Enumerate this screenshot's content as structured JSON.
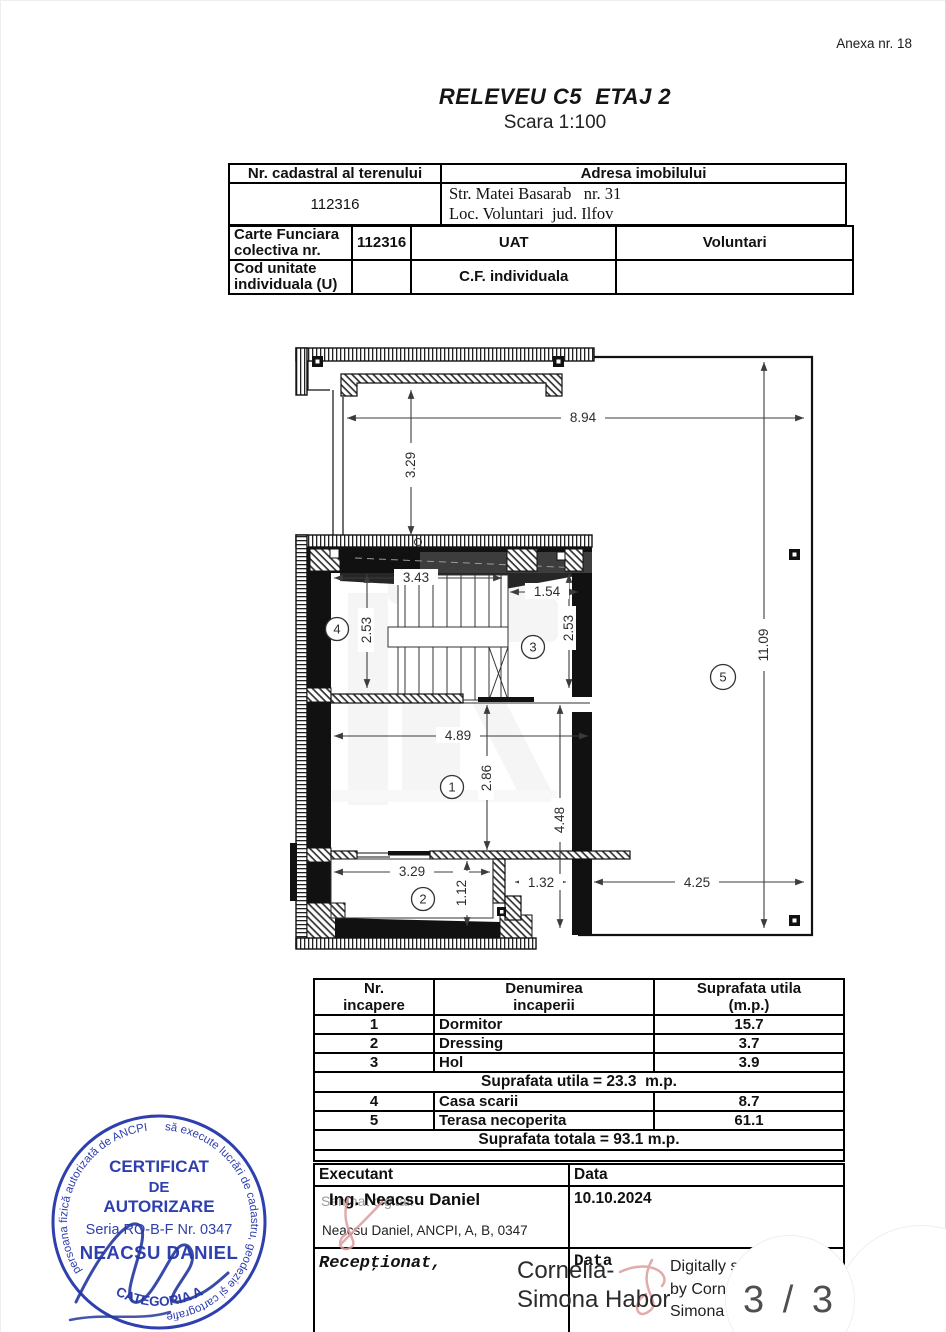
{
  "page": {
    "annex": "Anexa nr. 18",
    "title": "RELEVEU C5  ETAJ 2",
    "subtitle": "Scara 1:100",
    "page_indicator": "3 / 3"
  },
  "property_table": {
    "header_cadastral": "Nr. cadastral al terenului",
    "header_address": "Adresa imobilului",
    "cadastral_number": "112316",
    "address_line1": "Str. Matei Basarab   nr. 31",
    "address_line2": "Loc. Voluntari  jud. Ilfov"
  },
  "cf_table": {
    "row1_label": "Carte Funciara colectiva nr.",
    "row1_value": "112316",
    "row1_uat_label": "UAT",
    "row1_uat_value": "Voluntari",
    "row2_label": "Cod unitate individuala (U)",
    "row2_cf_label": "C.F. individuala"
  },
  "plan": {
    "rooms": {
      "r1": "1",
      "r2": "2",
      "r3": "3",
      "r4": "4",
      "r5": "5"
    },
    "dims": {
      "top_width": "8.94",
      "upper_left_height": "3.29",
      "stair_width": "3.43",
      "hol_width": "1.54",
      "stair_depth": "2.53",
      "hol_depth": "2.53",
      "room1_width": "4.89",
      "room1_depth": "2.86",
      "right_depth": "4.48",
      "room2_width": "3.29",
      "room2_depth": "1.12",
      "hall_width": "1.32",
      "terrace_bottom": "4.25",
      "terrace_height": "11.09"
    }
  },
  "areas_table": {
    "header": {
      "col1_line1": "Nr.",
      "col1_line2": "incapere",
      "col2_line1": "Denumirea",
      "col2_line2": "incaperii",
      "col3_line1": "Suprafata utila",
      "col3_line2": "(m.p.)"
    },
    "rows": [
      {
        "nr": "1",
        "name": "Dormitor",
        "area": "15.7"
      },
      {
        "nr": "2",
        "name": "Dressing",
        "area": "3.7"
      },
      {
        "nr": "3",
        "name": "Hol",
        "area": "3.9"
      }
    ],
    "subtotal": "Suprafata utila = 23.3  m.p.",
    "rows2": [
      {
        "nr": "4",
        "name": "Casa scarii",
        "area": "8.7"
      },
      {
        "nr": "5",
        "name": "Terasa necoperita",
        "area": "61.1"
      }
    ],
    "total": "Suprafata totala = 93.1 m.p."
  },
  "signature_block": {
    "executant_label": "Executant",
    "date_label": "Data",
    "digital_note": "Semnat digital:",
    "executant_name": "Ing. Neacsu Daniel",
    "executant_credentials": "Neacsu Daniel, ANCPI, A, B, 0347",
    "date_value": "10.10.2024",
    "received_label": "Recepţionat,",
    "received_date_label": "Data",
    "signer_name_line1": "Cornelia-",
    "signer_name_line2": "Simona Habor",
    "digital_sig_line1": "Digitally si",
    "digital_sig_line2": "by Corn",
    "digital_sig_line3": "Simona"
  },
  "stamp": {
    "ring_text_left": "persoana fizică autorizată de ANCPI",
    "ring_text_right": "să execute lucrări de cadastru, geodezie şi cartografie",
    "line1": "CERTIFICAT",
    "line2": "DE",
    "line3": "AUTORIZARE",
    "line4": "Seria RO-B-F Nr. 0347",
    "line5": "NEACSU DANIEL",
    "bottom_text": "CATEGORIA A",
    "ink_color": "#2e3fae",
    "flourish_color": "#dd9c9c"
  }
}
